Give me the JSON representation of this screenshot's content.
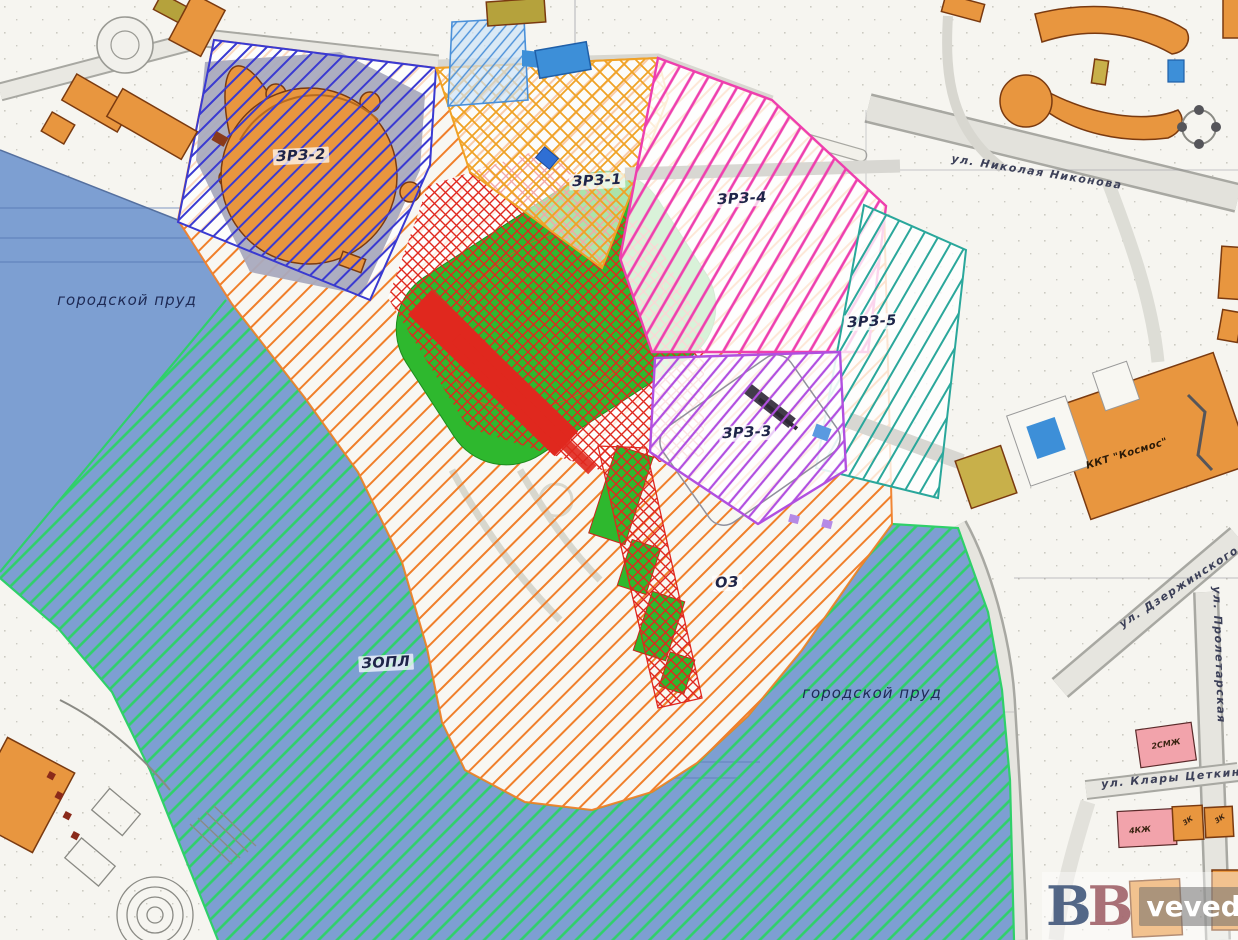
{
  "palette": {
    "paper": "#f6f5f0",
    "water": "#7d9fd2",
    "building": "#e8963f",
    "building_pink": "#f2a3ab",
    "building_khaki": "#b5a23c",
    "building_tan": "#c8b04a",
    "building_blue": "#3d8fd8",
    "stadium_green": "#2eb82e"
  },
  "zones": {
    "zrz2": {
      "label": "ЗРЗ-2",
      "color": "#3a3ad1"
    },
    "zrz1": {
      "label": "ЗРЗ-1",
      "color": "#f0a225"
    },
    "zrz4": {
      "label": "ЗРЗ-4",
      "color": "#ee3fae"
    },
    "zrz5": {
      "label": "ЗРЗ-5",
      "color": "#2aa79b"
    },
    "zrz3": {
      "label": "ЗРЗ-3",
      "color": "#b14fe0"
    },
    "oz": {
      "label": "ОЗ",
      "color": "#f07f2a"
    },
    "zopl": {
      "label": "ЗОПЛ",
      "color": "#2fd06a"
    },
    "stadium_zone": {
      "color": "#e0281e"
    }
  },
  "water_labels": {
    "left": "городской пруд",
    "right": "городской пруд"
  },
  "streets": {
    "nikonova": "ул. Николая Никонова",
    "dzerzhinskogo": "ул. Дзержинского",
    "proletarskaya": "ул. Пролетарская",
    "klary_tsetkin": "ул. Клары Цеткин"
  },
  "buildings": {
    "kosmos": "ККТ \"Космос\"",
    "pink_north": "2СМЖ",
    "pink_south": "4КЖ",
    "orange_east_a": "3К",
    "orange_east_b": "3К"
  },
  "watermark": {
    "letter1": "В",
    "letter2": "В",
    "site": "veved.ru"
  }
}
